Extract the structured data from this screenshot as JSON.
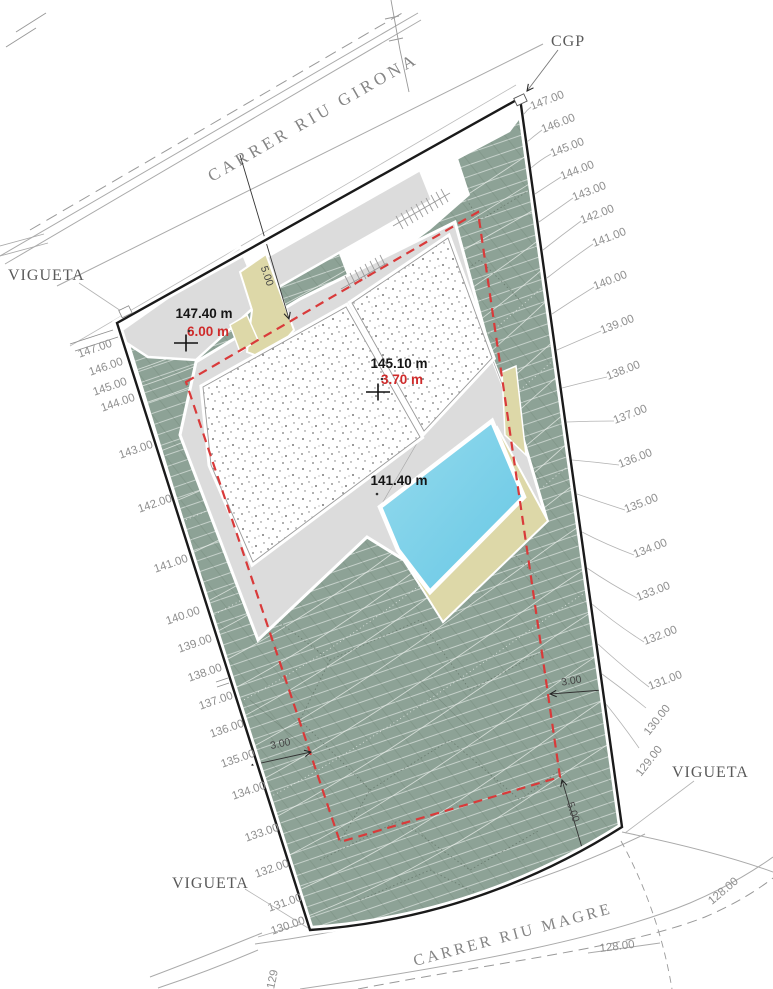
{
  "drawing": {
    "streets": {
      "top": "CARRER RIU GIRONA",
      "bottom": "CARRER RIU MAGRE"
    },
    "annotations": {
      "vigueta_top_left": "VIGUETA",
      "vigueta_right": "VIGUETA",
      "vigueta_bottom": "VIGUETA",
      "cgp": "CGP"
    },
    "spot_elevations": {
      "entry": {
        "elevation": "147.40 m",
        "height": "6.00 m"
      },
      "roof": {
        "elevation": "145.10 m",
        "height": "3.70 m"
      },
      "pool_deck": {
        "elevation": "141.40 m"
      }
    },
    "setback_dimensions": {
      "front": "5.00",
      "left": "3.00",
      "right": "3.00",
      "rear": "5.00"
    },
    "contour_labels": {
      "right": [
        "147.00",
        "146.00",
        "145.00",
        "144.00",
        "143.00",
        "142.00",
        "141.00",
        "140.00",
        "139.00",
        "138.00",
        "137.00",
        "136.00",
        "135.00",
        "134.00",
        "133.00",
        "132.00",
        "131.00",
        "130.00",
        "129.00"
      ],
      "left": [
        "147.00",
        "146.00",
        "145.00",
        "144.00",
        "143.00",
        "142.00",
        "141.00",
        "140.00",
        "139.00",
        "138.00",
        "137.00",
        "136.00",
        "135.00",
        "134.00",
        "133.00",
        "132.00",
        "131.00",
        "130.00",
        "129"
      ],
      "bottom": [
        "128.00",
        "128.00"
      ]
    },
    "colors": {
      "terrain_green": "#8da296",
      "pool_blue": "#7fd2ea",
      "planting_khaki": "#ddd8a8",
      "terrace_gray": "#dcdcdc",
      "setback_red": "#d93a3a"
    }
  }
}
